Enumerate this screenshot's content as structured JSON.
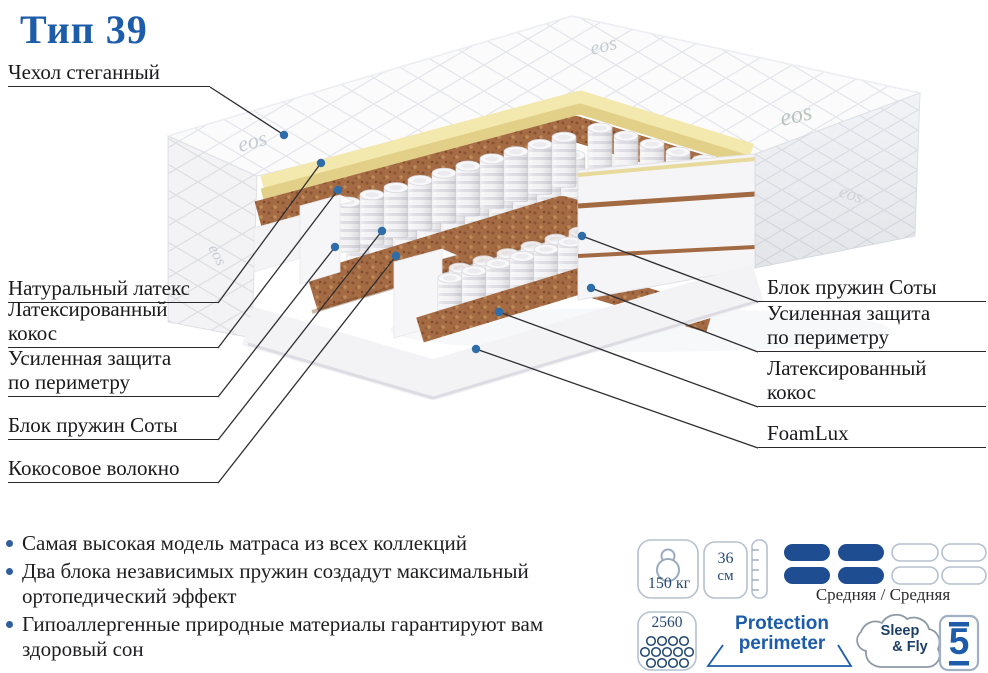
{
  "title": "Тип 39",
  "callouts": {
    "top": {
      "lines": [
        "Чехол стеганный"
      ]
    },
    "left": [
      {
        "lines": [
          "Натуральный латекс"
        ]
      },
      {
        "lines": [
          "Латексированный",
          "кокос"
        ]
      },
      {
        "lines": [
          "Усиленная защита",
          "по периметру"
        ]
      },
      {
        "lines": [
          "Блок пружин Соты"
        ]
      },
      {
        "lines": [
          "Кокосовое волокно"
        ]
      }
    ],
    "right": [
      {
        "lines": [
          "Блок пружин Соты"
        ]
      },
      {
        "lines": [
          "Усиленная защита",
          "по периметру"
        ]
      },
      {
        "lines": [
          "Латексированный",
          "кокос"
        ]
      },
      {
        "lines": [
          "FoamLux"
        ]
      }
    ]
  },
  "features": [
    {
      "lines": [
        "Самая высокая модель матраса из всех коллекций"
      ]
    },
    {
      "lines": [
        "Два блока независимых пружин создадут",
        "максимальный ортопедический эффект"
      ]
    },
    {
      "lines": [
        "Гипоаллергенные природные материалы гарантируют",
        "вам здоровый сон"
      ]
    }
  ],
  "badges": {
    "max_weight": {
      "value": "150 кг"
    },
    "height": {
      "value": "36",
      "unit": "см"
    },
    "firmness": {
      "label": "Средняя / Средняя",
      "filled": 2,
      "total": 4,
      "rows": 2
    },
    "springs_count": "2560",
    "protection": {
      "line1": "Protection",
      "line2": "perimeter"
    },
    "brand": {
      "line1": "Sleep",
      "line2": "& Fly"
    },
    "warranty": "5"
  },
  "fabric_logo": "eos",
  "colors": {
    "accent": "#1d5caa",
    "firmness_fill": "#1f4d92",
    "callout_dot": "#2e6da7",
    "latex": "#f3e8ae",
    "coir": "#a46b44"
  }
}
